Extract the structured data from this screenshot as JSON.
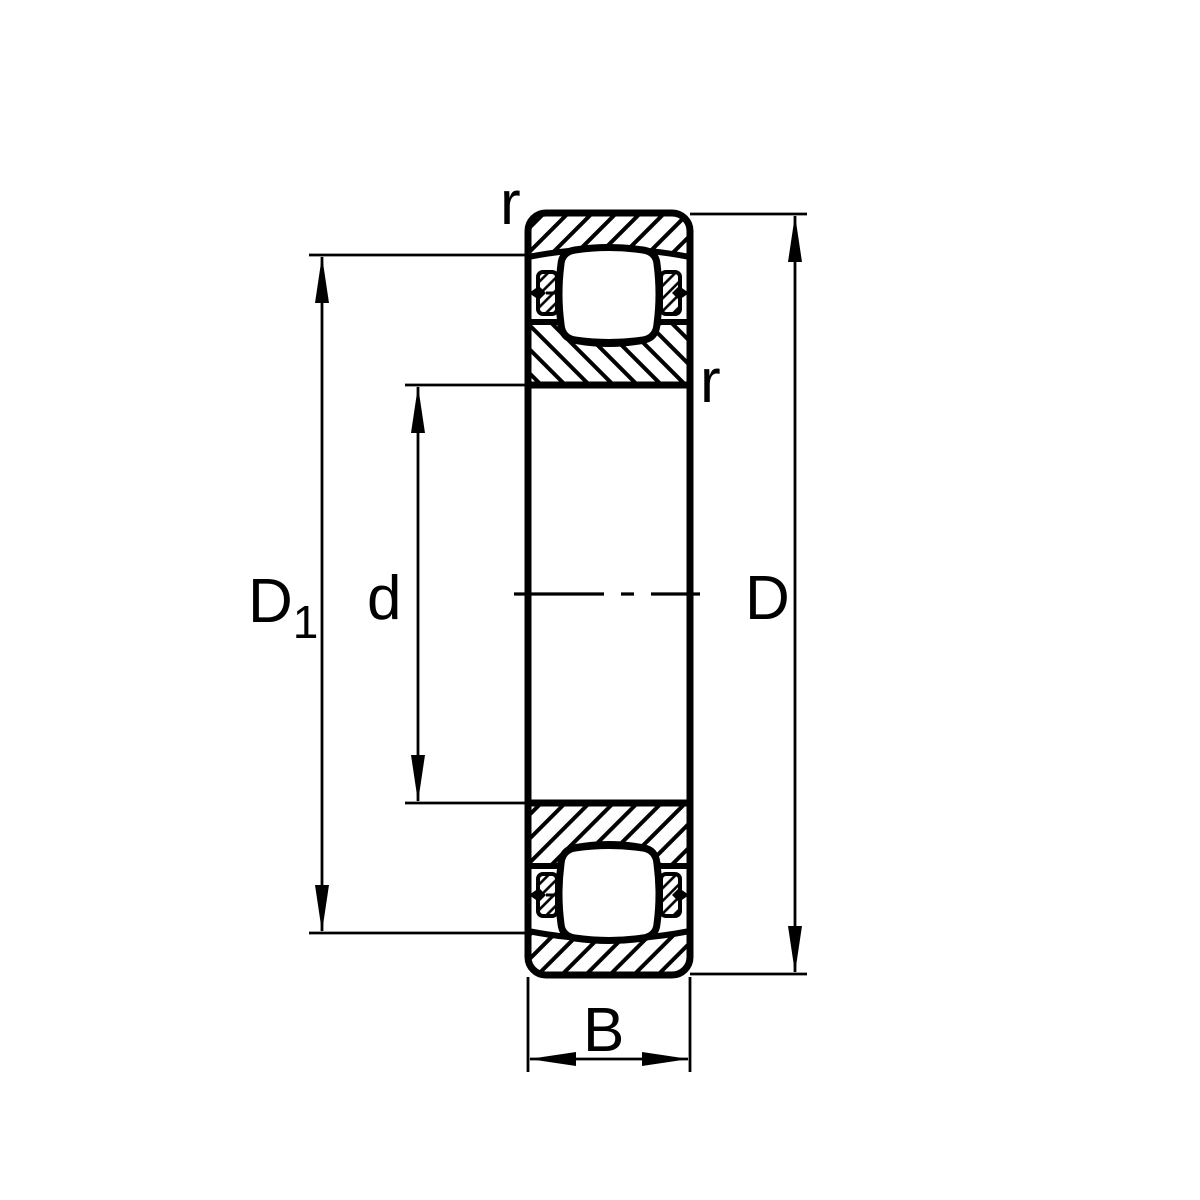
{
  "drawing": {
    "labels": {
      "radius_top": "r",
      "radius_inner": "r",
      "rib_diameter_main": "D",
      "rib_diameter_sub": "1",
      "bore_diameter": "d",
      "outside_diameter": "D",
      "width": "B"
    },
    "colors": {
      "line": "#000000",
      "background": "#ffffff"
    }
  }
}
